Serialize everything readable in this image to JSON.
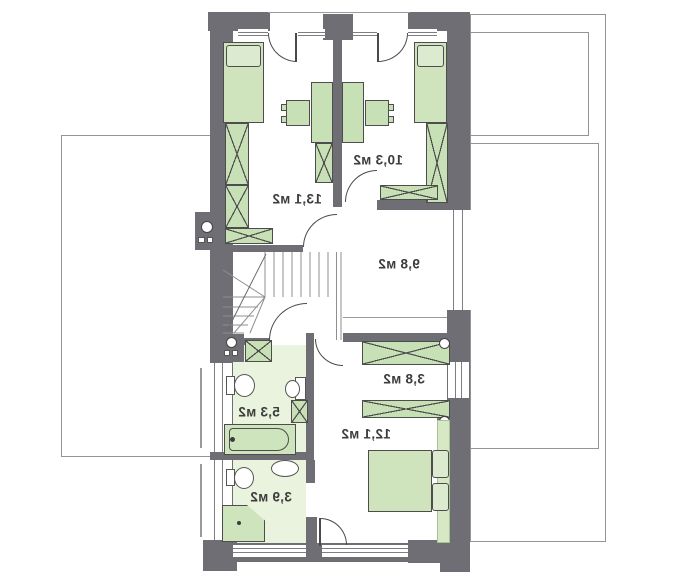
{
  "floor_plan": {
    "rooms": [
      {
        "key": "bedroom-top-left",
        "area_label": "13,1 м2"
      },
      {
        "key": "bedroom-top-right",
        "area_label": "10,3 м2"
      },
      {
        "key": "hall",
        "area_label": "9,8 м2"
      },
      {
        "key": "wardrobe-closet",
        "area_label": "3,8 м2"
      },
      {
        "key": "bedroom-bottom",
        "area_label": "12,1 м2"
      },
      {
        "key": "bathroom",
        "area_label": "5,3 м2"
      },
      {
        "key": "wc",
        "area_label": "3,9 м2"
      }
    ],
    "colors": {
      "wall": "#6e6e74",
      "furniture_fill": "#c8e0b6",
      "bathroom_floor": "#eaf3de",
      "outline": "#949494",
      "label_text": "#3c3c3c"
    }
  }
}
